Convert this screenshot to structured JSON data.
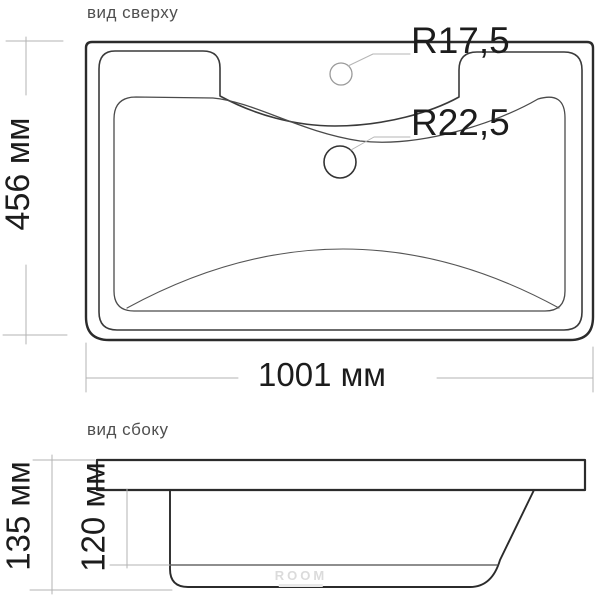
{
  "views": {
    "top": {
      "title": "вид сверху",
      "labels": {
        "faucet_hole_radius": "R17,5",
        "drain_hole_radius": "R22,5"
      },
      "dimensions": {
        "depth": "456 мм",
        "width": "1001 мм"
      }
    },
    "side": {
      "title": "вид сбоку",
      "dimensions": {
        "total_height": "135 мм",
        "bowl_height": "120 мм"
      }
    }
  },
  "watermark": "ROOM",
  "colors": {
    "outline": "#2b2b2b",
    "secondary_line": "#4a4a4a",
    "dimension_line": "#b3b3b3",
    "text": "#1c1c1c",
    "title": "#4f4f4f",
    "watermark": "#dbdbdb",
    "background": "#ffffff"
  }
}
